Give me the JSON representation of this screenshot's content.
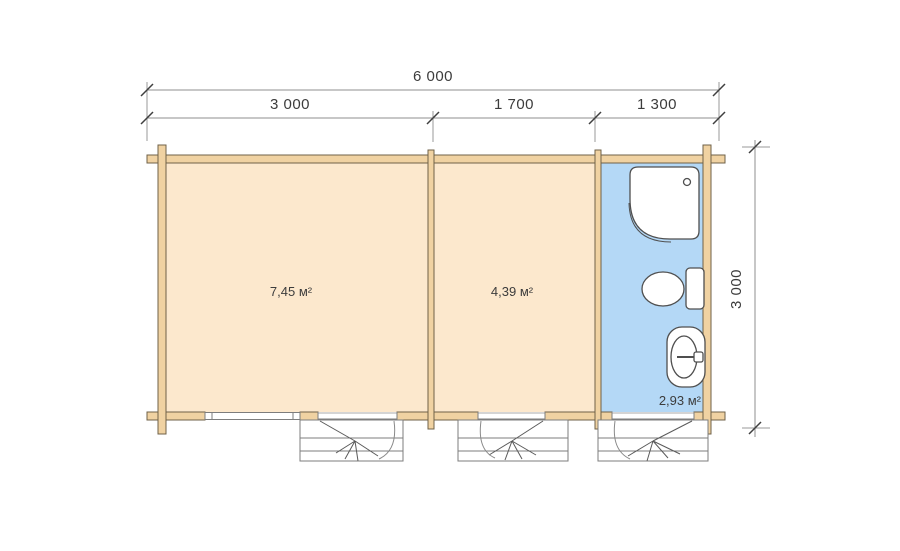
{
  "plan": {
    "title": "cabin-floor-plan",
    "dimensions": {
      "overall_width_mm": "6 000",
      "segments": [
        {
          "label": "3 000"
        },
        {
          "label": "1 700"
        },
        {
          "label": "1 300"
        }
      ],
      "overall_depth_mm": "3 000"
    },
    "rooms": [
      {
        "id": "room-1",
        "area_label": "7,45 м²"
      },
      {
        "id": "room-2",
        "area_label": "4,39 м²"
      },
      {
        "id": "bathroom",
        "area_label": "2,93 м²"
      }
    ],
    "fixtures": [
      "shower-tray",
      "toilet",
      "washbasin"
    ],
    "openings": [
      "window",
      "entrance-door-1",
      "entrance-door-2",
      "entrance-door-3"
    ],
    "colors": {
      "wall_fill": "#f0d2a2",
      "wall_outline": "#6f6148",
      "room_floor": "#fce8cd",
      "bathroom_floor": "#b4d8f6",
      "line": "#8f8f8f",
      "text": "#3c3c3c"
    }
  }
}
